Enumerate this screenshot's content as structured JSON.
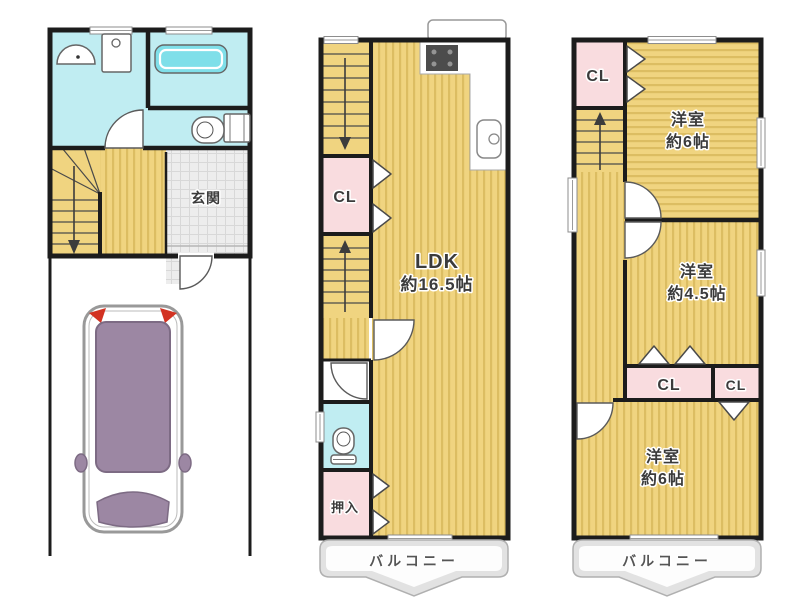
{
  "title": "3-story house floor plan with parking",
  "colors": {
    "wall": "#1c1c1c",
    "room_yellow": "#f0d480",
    "stripe_yellow": "#dcbd62",
    "closet_pink": "#f9dcdf",
    "water_cyan": "#c0edf2",
    "bathtub_cyan": "#7fdfe9",
    "tile_gray": "#ededed",
    "tile_line": "#d8d8d8",
    "balcony_fill": "#e2e2e2",
    "balcony_edge": "#b0b0b0",
    "car_body": "#9c87a3",
    "car_edge": "#7d6b84",
    "car_outline": "#999999",
    "car_light_red": "#d23222",
    "stove_dark": "#4c4c4c"
  },
  "icons": {
    "washbasin": "half-dome sink symbol",
    "washing_machine": "square with circle",
    "bathtub": "rounded tub symbol",
    "toilet": "bowl and tank symbol",
    "stove": "dark cooktop grid",
    "kitchen_sink": "rounded basin with faucet",
    "stairs_arrow": "direction of stair run",
    "car": "top view parked car"
  },
  "floor1": {
    "genkan": "玄関"
  },
  "floor2": {
    "closet": "CL",
    "ldk_name": "LDK",
    "ldk_size": "約16.5帖",
    "oshiire": "押入",
    "balcony": "バルコニー"
  },
  "floor3": {
    "closet_top": "CL",
    "room_top_name": "洋室",
    "room_top_size": "約6帖",
    "room_mid_name": "洋室",
    "room_mid_size": "約4.5帖",
    "closet_mid": "CL",
    "closet_mid_small": "CL",
    "room_bottom_name": "洋室",
    "room_bottom_size": "約6帖",
    "balcony": "バルコニー"
  }
}
